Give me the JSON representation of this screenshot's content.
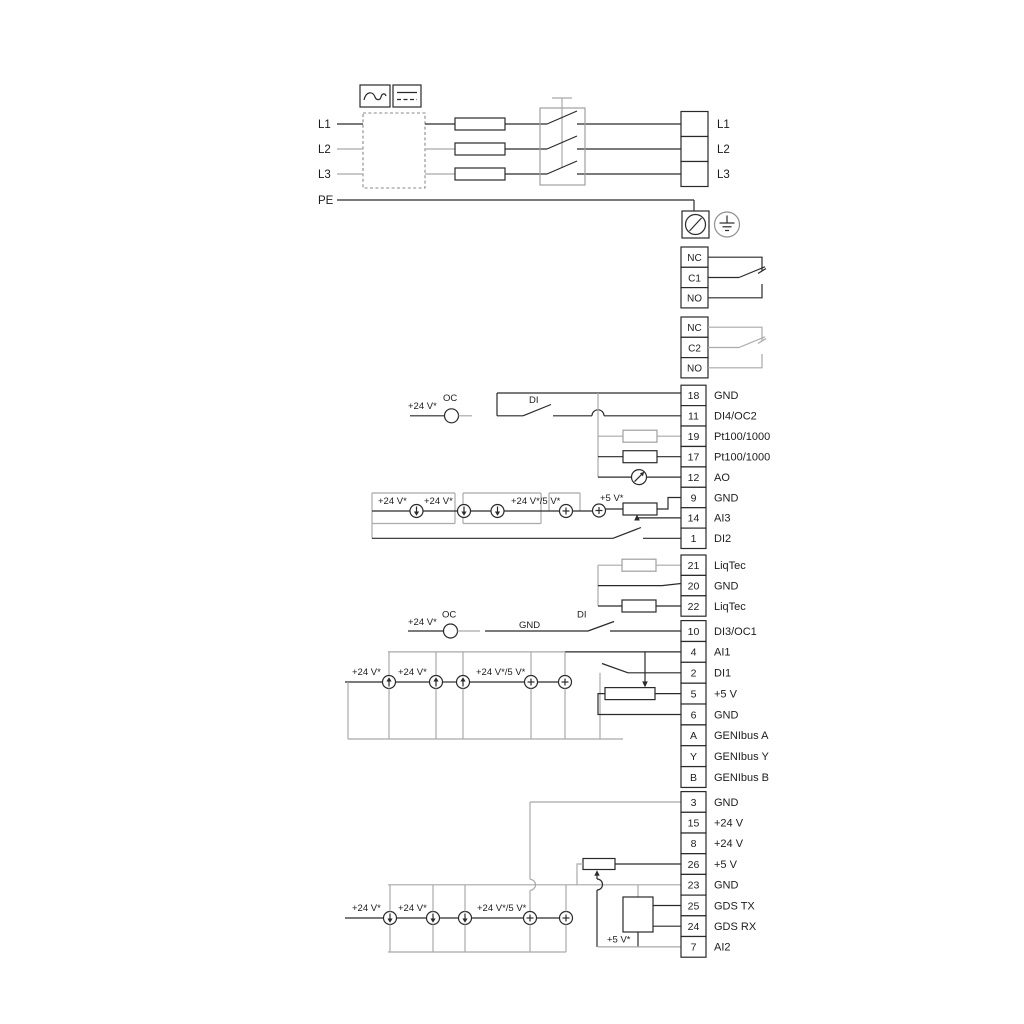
{
  "colors": {
    "background": "#ffffff",
    "line": "#2a2a2a",
    "line_gray": "#a9a9a9",
    "text": "#1c1c1c"
  },
  "power": {
    "input_labels": [
      "L1",
      "L2",
      "L3",
      "PE"
    ],
    "output_labels": [
      "L1",
      "L2",
      "L3"
    ]
  },
  "icons": {
    "converter_ac": "ac-wave",
    "converter_dc": "dc-line",
    "screw_terminal": "screw-terminal",
    "protective_earth": "protective-earth",
    "current_source_down": "current-source-arrow-down",
    "current_source_up": "current-source-arrow-up",
    "source_plus": "source-plus",
    "analog_output": "meter-arrow",
    "fuse": "fuse",
    "switch": "disconnect-switch",
    "resistor": "resistor",
    "potentiometer": "potentiometer"
  },
  "relays": [
    {
      "terminals": [
        "NC",
        "C1",
        "NO"
      ]
    },
    {
      "terminals": [
        "NC",
        "C2",
        "NO"
      ]
    }
  ],
  "terminal_groups": [
    {
      "rows": [
        {
          "num": "18",
          "label": "GND"
        },
        {
          "num": "11",
          "label": "DI4/OC2"
        },
        {
          "num": "19",
          "label": "Pt100/1000"
        },
        {
          "num": "17",
          "label": "Pt100/1000"
        },
        {
          "num": "12",
          "label": "AO"
        },
        {
          "num": "9",
          "label": "GND"
        },
        {
          "num": "14",
          "label": "AI3"
        },
        {
          "num": "1",
          "label": "DI2"
        }
      ]
    },
    {
      "rows": [
        {
          "num": "21",
          "label": "LiqTec"
        },
        {
          "num": "20",
          "label": "GND"
        },
        {
          "num": "22",
          "label": "LiqTec"
        }
      ]
    },
    {
      "rows": [
        {
          "num": "10",
          "label": "DI3/OC1"
        },
        {
          "num": "4",
          "label": "AI1"
        },
        {
          "num": "2",
          "label": "DI1"
        },
        {
          "num": "5",
          "label": "+5 V"
        },
        {
          "num": "6",
          "label": "GND"
        },
        {
          "num": "A",
          "label": "GENIbus A"
        },
        {
          "num": "Y",
          "label": "GENIbus Y"
        },
        {
          "num": "B",
          "label": "GENIbus B"
        }
      ]
    },
    {
      "rows": [
        {
          "num": "3",
          "label": "GND"
        },
        {
          "num": "15",
          "label": "+24 V"
        },
        {
          "num": "8",
          "label": "+24 V"
        },
        {
          "num": "26",
          "label": "+5 V"
        },
        {
          "num": "23",
          "label": "GND"
        },
        {
          "num": "25",
          "label": "GDS TX"
        },
        {
          "num": "24",
          "label": "GDS RX"
        },
        {
          "num": "7",
          "label": "AI2"
        }
      ]
    }
  ],
  "annotations": {
    "di4": {
      "v24": "+24 V*",
      "oc": "OC",
      "di": "DI"
    },
    "di3": {
      "v24": "+24 V*",
      "oc": "OC",
      "gnd": "GND",
      "di": "DI"
    },
    "ai3": {
      "v24_a": "+24 V*",
      "v24_b": "+24 V*",
      "v24_5": "+24 V*/5 V*",
      "v5": "+5 V*"
    },
    "ai1": {
      "v24_a": "+24 V*",
      "v24_b": "+24 V*",
      "v24_5": "+24 V*/5 V*"
    },
    "ai2": {
      "v24_a": "+24 V*",
      "v24_b": "+24 V*",
      "v24_5": "+24 V*/5 V*",
      "v5": "+5 V*"
    }
  }
}
